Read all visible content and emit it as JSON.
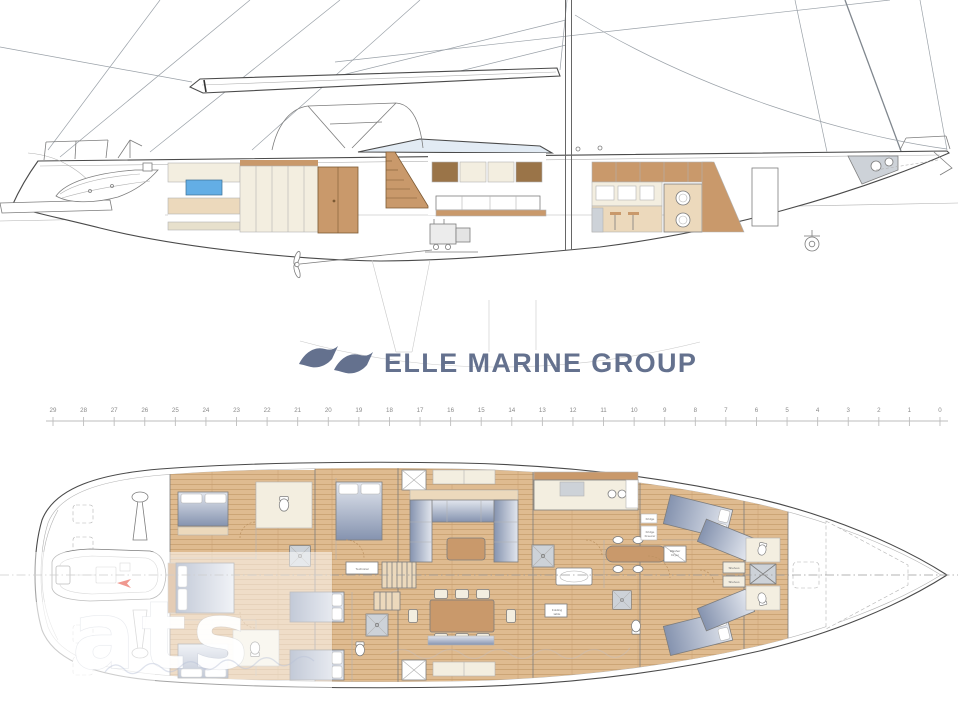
{
  "logo": {
    "text": "ELLE MARINE GROUP",
    "color": "#64718e"
  },
  "watermark": {
    "text": "ats"
  },
  "ruler": {
    "labels": [
      "29",
      "28",
      "27",
      "26",
      "25",
      "24",
      "23",
      "22",
      "21",
      "20",
      "19",
      "18",
      "17",
      "16",
      "15",
      "14",
      "13",
      "12",
      "11",
      "10",
      "9",
      "8",
      "7",
      "6",
      "5",
      "4",
      "3",
      "2",
      "1",
      "0"
    ]
  },
  "plan_labels": [
    {
      "t": "Technical",
      "x": 362,
      "y": 570
    },
    {
      "t": "Fridge",
      "x": 650,
      "y": 520
    },
    {
      "t": "Fridge",
      "x": 650,
      "y": 533
    },
    {
      "t": "Freezer",
      "x": 650,
      "y": 537
    },
    {
      "t": "Washer",
      "x": 675,
      "y": 552
    },
    {
      "t": "Dryer",
      "x": 675,
      "y": 556
    },
    {
      "t": "Shelves",
      "x": 734,
      "y": 569
    },
    {
      "t": "Shelves",
      "x": 734,
      "y": 583
    },
    {
      "t": "Folding",
      "x": 557,
      "y": 611
    },
    {
      "t": "table",
      "x": 557,
      "y": 615
    }
  ],
  "colors": {
    "line_dark": "#4a4a4a",
    "line": "#7d7d7d",
    "line_light": "#b2b2b2",
    "wood_floor": "#dfbb90",
    "wood_plank_line": "#c69e6e",
    "wood_cab": "#c9996b",
    "wood_dark": "#a97b49",
    "wood_pale": "#ecd9bc",
    "cream": "#f3eee0",
    "cream_dark": "#e7e0cc",
    "bed_dark": "#8593af",
    "bed_light": "#e2e6ee",
    "glass_blue": "#63aee5",
    "gray_fill": "#cdd2d8",
    "logo_blue": "#64718e",
    "ruler_text": "#8a8a8a",
    "red_marker": "#e0301e"
  }
}
